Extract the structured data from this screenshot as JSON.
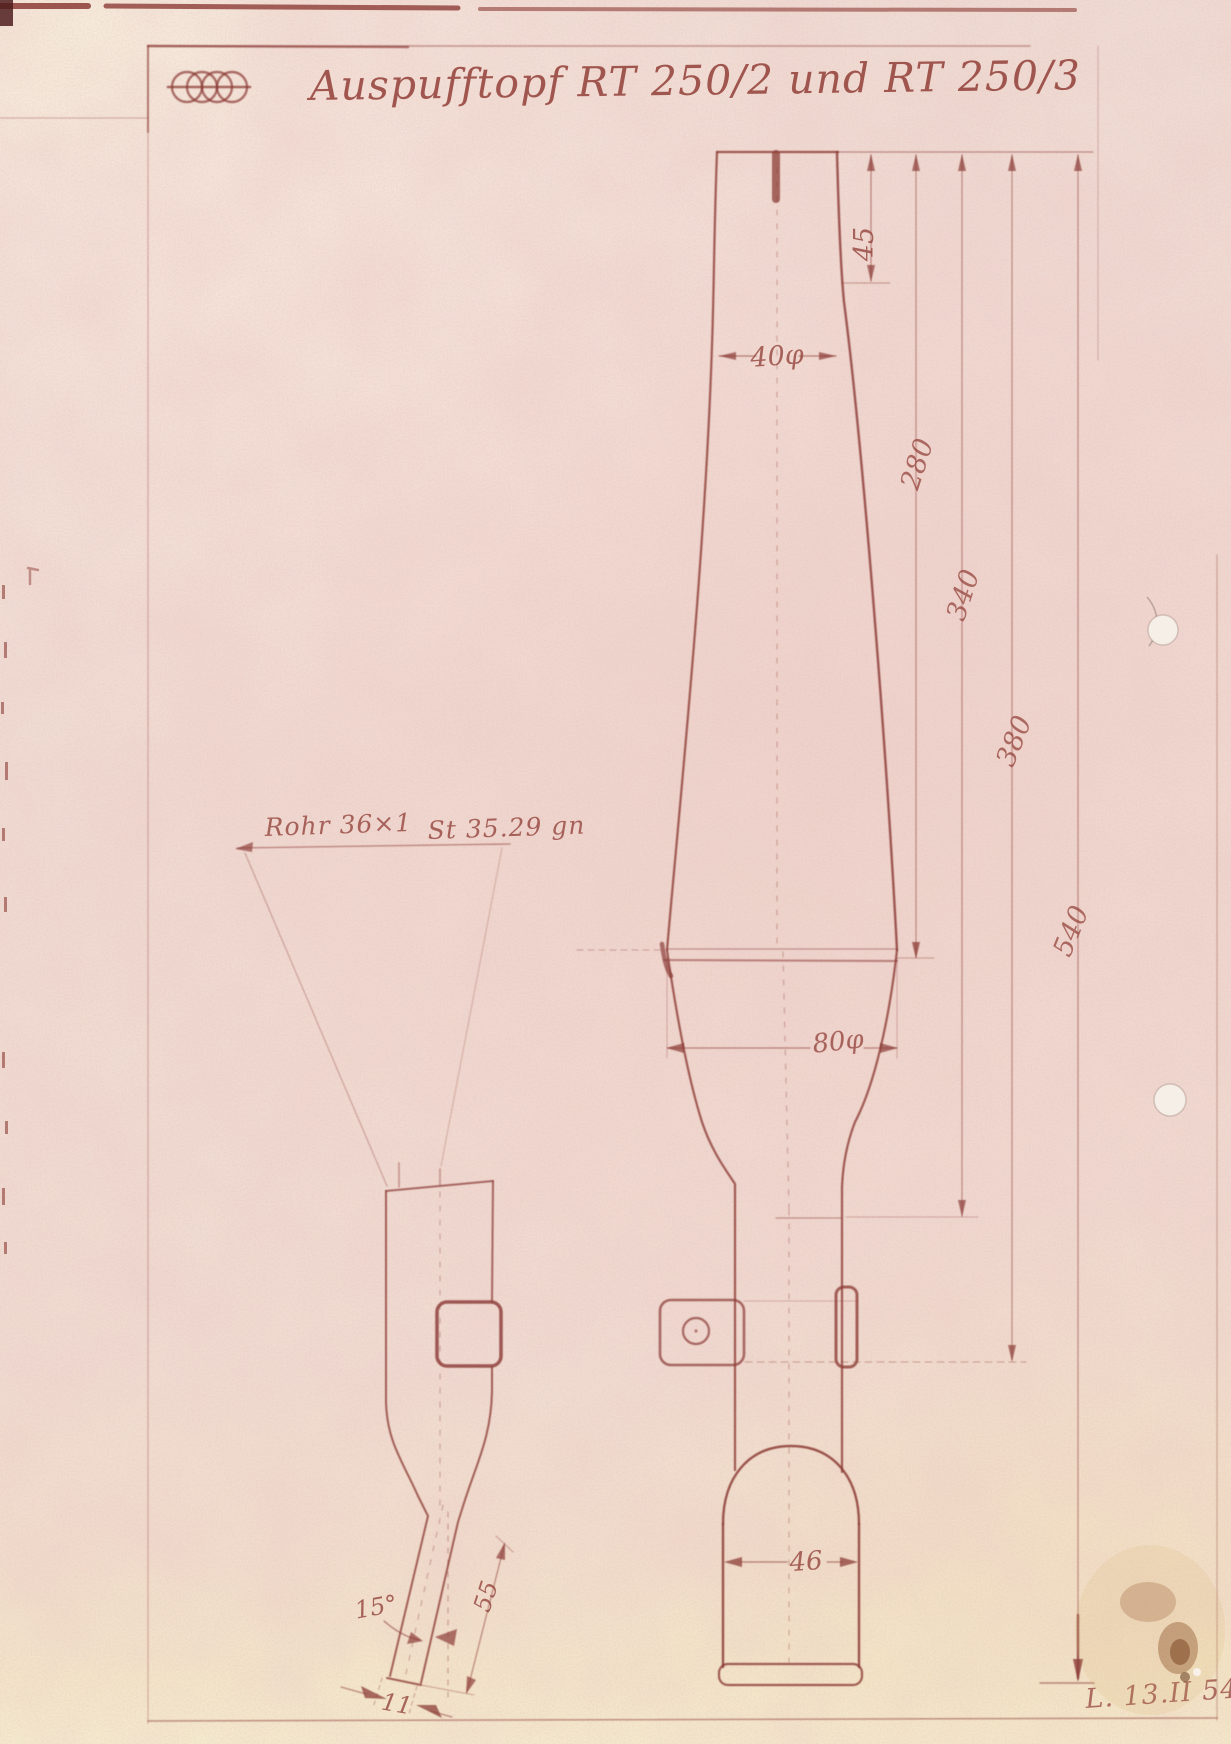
{
  "page": {
    "title": "Auspufftopf  RT 250/2 und RT 250/3",
    "signature": "L. 13.II 54",
    "ink_color": "#8c3c36",
    "paper_color": "#efdcd4",
    "logo": "four-interlocked-rings"
  },
  "notes": {
    "tube": "Rohr 36×1",
    "material": "St 35.29 gn"
  },
  "dimensions": {
    "inlet_length": "45",
    "inlet_diameter": "40φ",
    "length_to_seam": "280",
    "length_to_baffle": "340",
    "length_to_bracket": "380",
    "total_length": "540",
    "body_diameter": "80φ",
    "tail_width": "46",
    "tip_angle": "15°",
    "tip_length": "55",
    "tip_width": "11"
  }
}
